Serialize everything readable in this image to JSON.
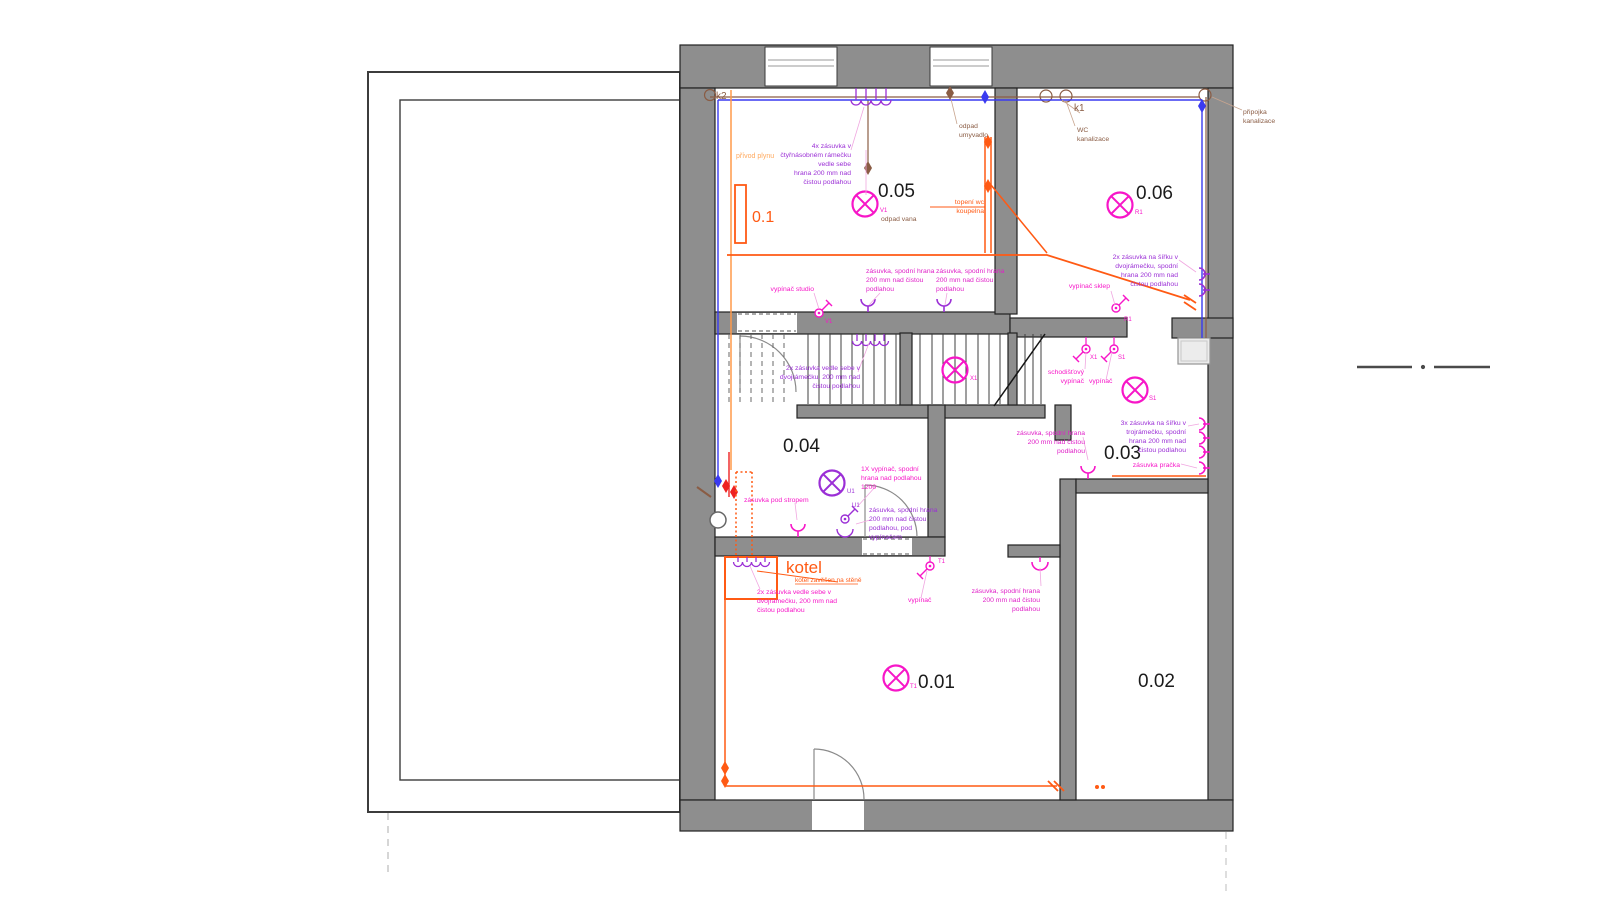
{
  "rooms": {
    "r05": "0.05",
    "r06": "0.06",
    "r04": "0.04",
    "r03": "0.03",
    "r01": "0.01",
    "r02": "0.02",
    "gas_riser": "0.1"
  },
  "kotel": {
    "title": "kotel",
    "note": "kotel zavěšen na stěně"
  },
  "plumbing": {
    "k1": "k1",
    "k2": "k2",
    "wc": [
      "WC",
      "kanalizace"
    ],
    "pripojka": [
      "připojka",
      "kanalizace"
    ],
    "odpad_umyvadlo": [
      "odpad",
      "umyvadlo"
    ],
    "odpad_vana": "odpad vana",
    "privod_plynu": "přívod plynu",
    "topeni": [
      "topení wc",
      "koupelna"
    ]
  },
  "devices": {
    "V1": "V1",
    "R1": "R1",
    "X1": "X1",
    "S1": "S1",
    "U1": "U1",
    "T1": "T1"
  },
  "annotations": {
    "ctyrnasobny": [
      "4x zásuvka v",
      "čtyřnásobném rámečku",
      "vedle sebe",
      "hrana 200 mm nad",
      "čistou podlahou"
    ],
    "zasuvka_spodni": [
      "zásuvka, spodní hrana",
      "200 mm nad čistou",
      "podlahou"
    ],
    "dvoj_vedle": [
      "2x zásuvka vedle sebe v",
      "dvojrámečku, 200 mm nad",
      "čistou podlahou"
    ],
    "dvoj_sirka": [
      "2x zásuvka na šířku v",
      "dvojrámečku, spodní",
      "hrana 200 mm nad",
      "čistou podlahou"
    ],
    "troj_sirka": [
      "3x zásuvka na šířku v",
      "trojrámečku, spodní",
      "hrana 200 mm nad",
      "čistou podlahou"
    ],
    "vypinac_studio": "vypínač studio",
    "vypinac_sklep": "vypínač sklep",
    "schodistovy": [
      "schodišťový",
      "vypínač"
    ],
    "vypinac": "vypínač",
    "vypinac_1x": [
      "1X vypínač, spodní",
      "hrana nad podlahou",
      "1200"
    ],
    "zasuvka_pod_vyp": [
      "zásuvka, spodní hrana",
      "200 mm nad čistou",
      "podlahou, pod",
      "vypínačem"
    ],
    "zasuvka_strop": "zásuvka pod stropem",
    "zasuvka_pracka": "zásuvka pračka"
  },
  "colors": {
    "wall": "#8e8e8e",
    "magenta": "#f716c8",
    "violet": "#9b2fd6",
    "orange": "#ff5a14",
    "gas_orange": "#ffa95e",
    "brown": "#8a5c44",
    "blue": "#3a3af0",
    "red": "#ee2222"
  }
}
